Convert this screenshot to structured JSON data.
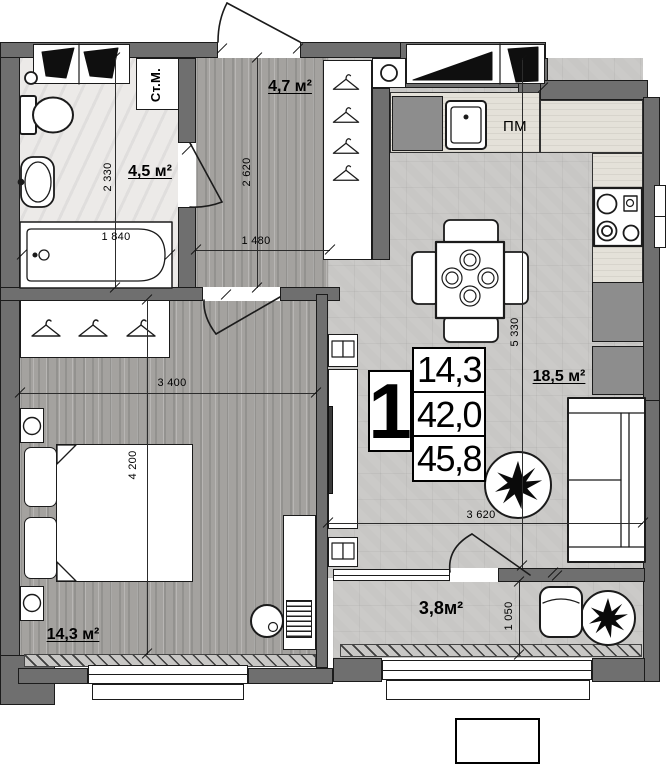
{
  "plan": {
    "apartment": {
      "number": "1",
      "rows": [
        "14,3",
        "42,0",
        "45,8"
      ]
    },
    "bathroom": {
      "area": "4,5 м²",
      "height_dim": "2 330",
      "tub_dim": "1 840",
      "washer": "Ст.М."
    },
    "hall": {
      "area": "4,7 м²",
      "height_dim": "2 620",
      "width_dim": "1 480"
    },
    "kitchen": {
      "area": "18,5 м²",
      "height_dim": "5 330",
      "width_dim": "3 620",
      "dishwasher": "ПМ"
    },
    "bedroom": {
      "area": "14,3 м²",
      "width_dim": "3 400",
      "height_dim": "4 200"
    },
    "balcony": {
      "area": "3,8м²",
      "depth_dim": "1 050"
    }
  },
  "colors": {
    "wall": "#6f6f6f",
    "outline": "#1b1b1b",
    "floor_wood": "#a4a29f",
    "floor_tile": "#c8c7c5",
    "floor_marble": "#eceae8",
    "accent_black": "#0a0a0a"
  }
}
